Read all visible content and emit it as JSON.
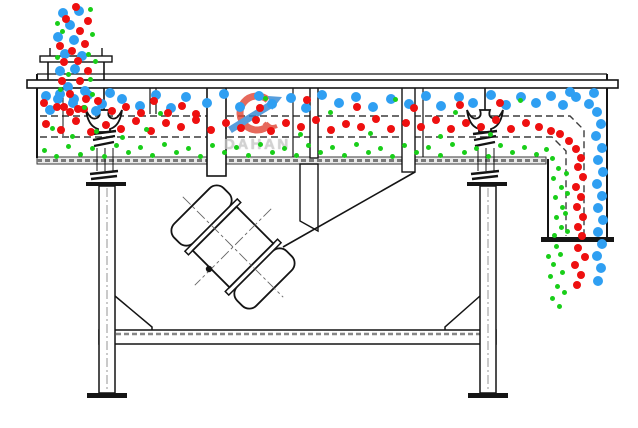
{
  "watermark": {
    "brand": "DAHAN",
    "registered": "®"
  },
  "colors": {
    "blue": "#2f9ff2",
    "red": "#ee1010",
    "green": "#19ce19",
    "logo_red": "#e04434",
    "logo_blue": "#2e86d4",
    "line": "#141414"
  },
  "particle_sizes": {
    "blue": 10,
    "red": 8,
    "green": 5
  },
  "particles": {
    "blue": [
      [
        63,
        13
      ],
      [
        79,
        11
      ],
      [
        70,
        25
      ],
      [
        58,
        37
      ],
      [
        74,
        40
      ],
      [
        65,
        54
      ],
      [
        82,
        56
      ],
      [
        60,
        71
      ],
      [
        75,
        69
      ],
      [
        68,
        87
      ],
      [
        85,
        91
      ],
      [
        58,
        99
      ],
      [
        73,
        103
      ],
      [
        46,
        96
      ],
      [
        60,
        94
      ],
      [
        74,
        99
      ],
      [
        88,
        95
      ],
      [
        102,
        104
      ],
      [
        50,
        110
      ],
      [
        96,
        111
      ],
      [
        110,
        93
      ],
      [
        122,
        99
      ],
      [
        140,
        106
      ],
      [
        156,
        95
      ],
      [
        171,
        108
      ],
      [
        186,
        97
      ],
      [
        207,
        103
      ],
      [
        224,
        94
      ],
      [
        240,
        107
      ],
      [
        259,
        96
      ],
      [
        272,
        104
      ],
      [
        291,
        98
      ],
      [
        306,
        108
      ],
      [
        322,
        95
      ],
      [
        339,
        103
      ],
      [
        356,
        97
      ],
      [
        373,
        107
      ],
      [
        391,
        99
      ],
      [
        409,
        104
      ],
      [
        426,
        96
      ],
      [
        441,
        106
      ],
      [
        459,
        97
      ],
      [
        473,
        103
      ],
      [
        491,
        95
      ],
      [
        506,
        105
      ],
      [
        521,
        97
      ],
      [
        536,
        103
      ],
      [
        551,
        96
      ],
      [
        563,
        105
      ],
      [
        576,
        97
      ],
      [
        589,
        104
      ],
      [
        594,
        93
      ],
      [
        570,
        92
      ],
      [
        597,
        112
      ],
      [
        601,
        124
      ],
      [
        596,
        136
      ],
      [
        602,
        148
      ],
      [
        598,
        160
      ],
      [
        603,
        172
      ],
      [
        597,
        184
      ],
      [
        602,
        196
      ],
      [
        598,
        208
      ],
      [
        603,
        220
      ],
      [
        598,
        232
      ],
      [
        602,
        244
      ],
      [
        597,
        256
      ],
      [
        601,
        268
      ],
      [
        598,
        281
      ]
    ],
    "red": [
      [
        76,
        7
      ],
      [
        88,
        21
      ],
      [
        66,
        19
      ],
      [
        80,
        31
      ],
      [
        60,
        46
      ],
      [
        85,
        44
      ],
      [
        72,
        51
      ],
      [
        64,
        62
      ],
      [
        78,
        61
      ],
      [
        88,
        71
      ],
      [
        62,
        81
      ],
      [
        80,
        81
      ],
      [
        70,
        94
      ],
      [
        86,
        99
      ],
      [
        64,
        107
      ],
      [
        78,
        109
      ],
      [
        44,
        103
      ],
      [
        57,
        107
      ],
      [
        70,
        112
      ],
      [
        84,
        109
      ],
      [
        98,
        101
      ],
      [
        112,
        111
      ],
      [
        126,
        107
      ],
      [
        141,
        113
      ],
      [
        154,
        101
      ],
      [
        168,
        113
      ],
      [
        182,
        106
      ],
      [
        196,
        114
      ],
      [
        260,
        108
      ],
      [
        307,
        100
      ],
      [
        357,
        107
      ],
      [
        414,
        108
      ],
      [
        460,
        105
      ],
      [
        500,
        103
      ],
      [
        46,
        124
      ],
      [
        61,
        130
      ],
      [
        76,
        121
      ],
      [
        91,
        132
      ],
      [
        106,
        125
      ],
      [
        121,
        129
      ],
      [
        136,
        121
      ],
      [
        151,
        131
      ],
      [
        166,
        123
      ],
      [
        181,
        127
      ],
      [
        196,
        120
      ],
      [
        211,
        130
      ],
      [
        226,
        123
      ],
      [
        241,
        128
      ],
      [
        256,
        120
      ],
      [
        271,
        131
      ],
      [
        286,
        123
      ],
      [
        301,
        127
      ],
      [
        316,
        120
      ],
      [
        331,
        130
      ],
      [
        346,
        124
      ],
      [
        361,
        127
      ],
      [
        376,
        119
      ],
      [
        391,
        129
      ],
      [
        406,
        123
      ],
      [
        421,
        127
      ],
      [
        436,
        120
      ],
      [
        451,
        129
      ],
      [
        466,
        123
      ],
      [
        481,
        127
      ],
      [
        496,
        120
      ],
      [
        511,
        129
      ],
      [
        526,
        123
      ],
      [
        539,
        127
      ],
      [
        551,
        131
      ],
      [
        560,
        134
      ],
      [
        569,
        141
      ],
      [
        576,
        149
      ],
      [
        581,
        158
      ],
      [
        578,
        167
      ],
      [
        583,
        177
      ],
      [
        576,
        187
      ],
      [
        581,
        197
      ],
      [
        577,
        207
      ],
      [
        583,
        217
      ],
      [
        578,
        227
      ],
      [
        582,
        236
      ],
      [
        578,
        248
      ],
      [
        585,
        257
      ],
      [
        575,
        265
      ],
      [
        581,
        275
      ],
      [
        577,
        285
      ]
    ],
    "green": [
      [
        90,
        9
      ],
      [
        57,
        23
      ],
      [
        92,
        34
      ],
      [
        62,
        31
      ],
      [
        88,
        54
      ],
      [
        95,
        61
      ],
      [
        57,
        57
      ],
      [
        90,
        79
      ],
      [
        60,
        89
      ],
      [
        92,
        94
      ],
      [
        68,
        74
      ],
      [
        84,
        107
      ],
      [
        160,
        113
      ],
      [
        265,
        98
      ],
      [
        330,
        112
      ],
      [
        395,
        99
      ],
      [
        455,
        112
      ],
      [
        520,
        100
      ],
      [
        52,
        128
      ],
      [
        72,
        136
      ],
      [
        96,
        131
      ],
      [
        122,
        137
      ],
      [
        146,
        129
      ],
      [
        300,
        134
      ],
      [
        370,
        133
      ],
      [
        440,
        136
      ],
      [
        490,
        134
      ],
      [
        44,
        150
      ],
      [
        56,
        156
      ],
      [
        68,
        146
      ],
      [
        80,
        154
      ],
      [
        92,
        148
      ],
      [
        104,
        156
      ],
      [
        116,
        145
      ],
      [
        128,
        152
      ],
      [
        140,
        147
      ],
      [
        152,
        155
      ],
      [
        164,
        144
      ],
      [
        176,
        152
      ],
      [
        188,
        148
      ],
      [
        200,
        156
      ],
      [
        212,
        145
      ],
      [
        224,
        152
      ],
      [
        236,
        147
      ],
      [
        248,
        155
      ],
      [
        260,
        144
      ],
      [
        272,
        152
      ],
      [
        284,
        148
      ],
      [
        296,
        155
      ],
      [
        308,
        145
      ],
      [
        320,
        152
      ],
      [
        332,
        147
      ],
      [
        344,
        155
      ],
      [
        356,
        144
      ],
      [
        368,
        152
      ],
      [
        380,
        148
      ],
      [
        392,
        156
      ],
      [
        404,
        145
      ],
      [
        416,
        152
      ],
      [
        428,
        147
      ],
      [
        440,
        155
      ],
      [
        452,
        144
      ],
      [
        464,
        152
      ],
      [
        476,
        148
      ],
      [
        488,
        156
      ],
      [
        500,
        145
      ],
      [
        512,
        152
      ],
      [
        524,
        147
      ],
      [
        536,
        154
      ],
      [
        546,
        149
      ],
      [
        552,
        158
      ],
      [
        558,
        168
      ],
      [
        553,
        178
      ],
      [
        561,
        187
      ],
      [
        555,
        197
      ],
      [
        562,
        207
      ],
      [
        556,
        217
      ],
      [
        561,
        227
      ],
      [
        554,
        235
      ],
      [
        566,
        173
      ],
      [
        567,
        193
      ],
      [
        565,
        213
      ],
      [
        567,
        231
      ],
      [
        556,
        246
      ],
      [
        548,
        256
      ],
      [
        560,
        254
      ],
      [
        553,
        264
      ],
      [
        562,
        272
      ],
      [
        550,
        276
      ],
      [
        557,
        286
      ],
      [
        564,
        292
      ],
      [
        552,
        298
      ],
      [
        559,
        306
      ]
    ]
  }
}
